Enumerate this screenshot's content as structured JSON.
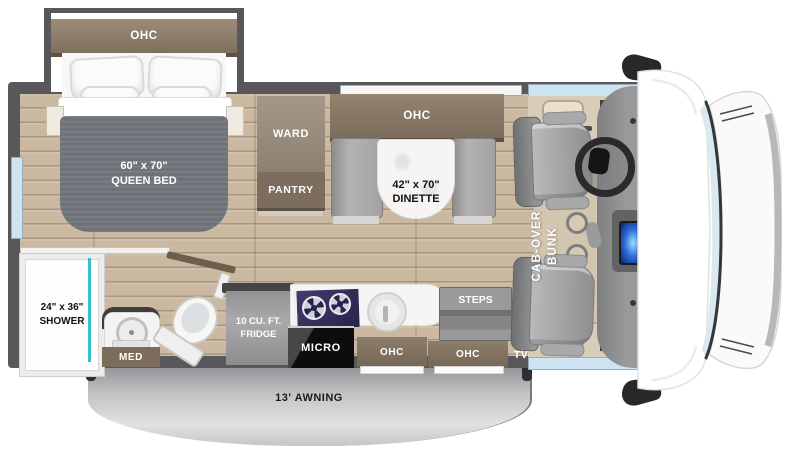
{
  "title": "Class C motorhome floor plan",
  "labels": {
    "bed_ohc": "OHC",
    "bed_size": "60\" x 70\"",
    "bed_name": "QUEEN BED",
    "ward": "WARD",
    "pantry": "PANTRY",
    "dinette_ohc": "OHC",
    "dinette_size": "42\" x 70\"",
    "dinette_name": "DINETTE",
    "shower_size": "24\" x 36\"",
    "shower_name": "SHOWER",
    "med": "MED",
    "fridge_line1": "10 CU. FT.",
    "fridge_line2": "FRIDGE",
    "micro": "MICRO",
    "kitchen_ohc": "OHC",
    "entry_ohc": "OHC",
    "steps": "STEPS",
    "tv": "TV",
    "bunk_line1": "CAB-OVER",
    "bunk_line2": "BUNK",
    "awning": "13' AWNING"
  },
  "colors": {
    "wall": "#58585a",
    "floor_wood": "#cbb8a1",
    "cabinet_brown": "#7e6f5f",
    "glass_blue": "#cfe4f2",
    "shower_teal": "#35c0cf",
    "stove_navy": "#27234a",
    "awning_gray": "#c2c2c4",
    "bench_gray": "#a3a2a0"
  }
}
